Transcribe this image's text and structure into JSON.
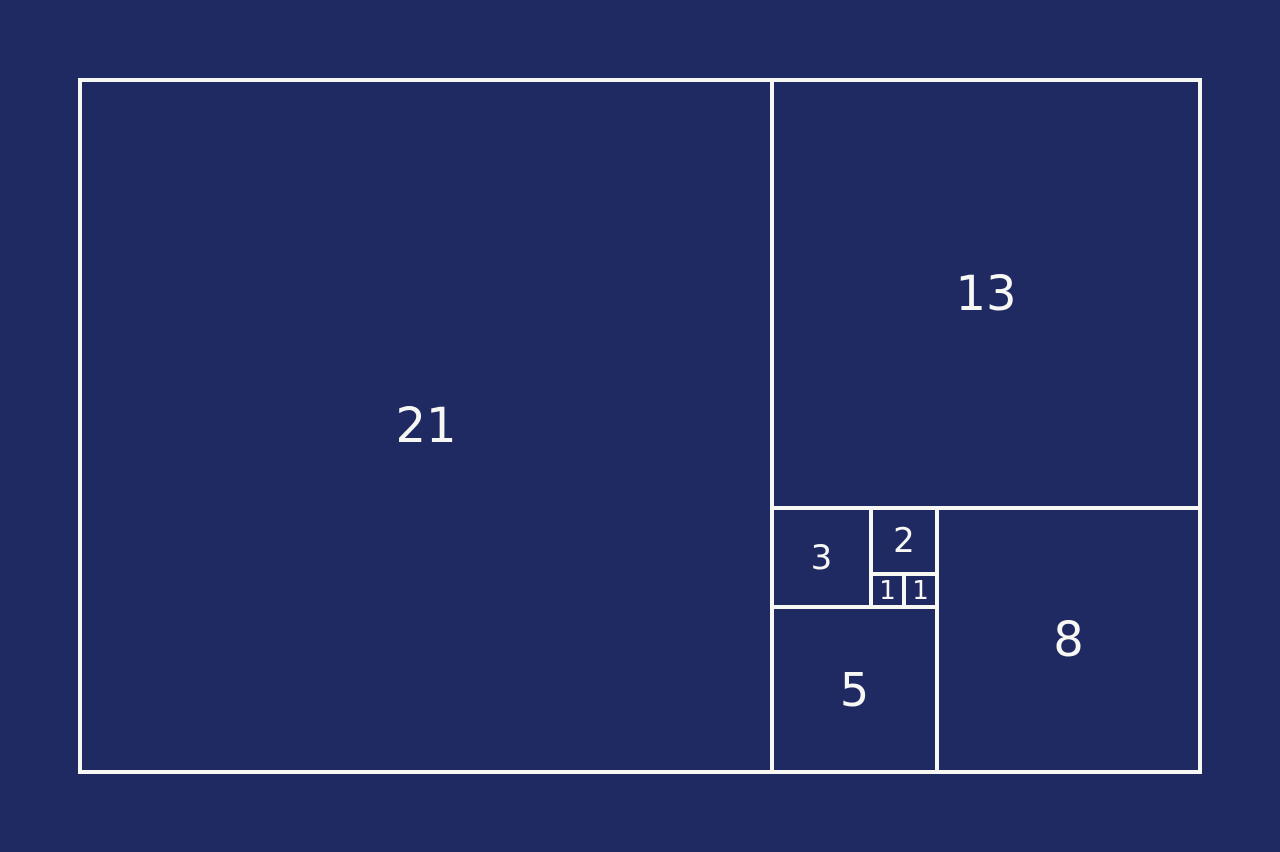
{
  "colors": {
    "background": "#1f2a63",
    "line": "#f7f7f3",
    "text": "#f7f7f3"
  },
  "diagram": {
    "type": "fibonacci-golden-rectangle",
    "units": {
      "width": 34,
      "height": 21
    },
    "origin_px": {
      "x": 80,
      "y": 80
    },
    "unit_px": 32.95,
    "line_px": 4,
    "squares": [
      {
        "label": "21",
        "x": 0,
        "y": 0,
        "size": 21,
        "font_px": 48
      },
      {
        "label": "13",
        "x": 21,
        "y": 0,
        "size": 13,
        "font_px": 48
      },
      {
        "label": "8",
        "x": 26,
        "y": 13,
        "size": 8,
        "font_px": 48
      },
      {
        "label": "5",
        "x": 21,
        "y": 16,
        "size": 5,
        "font_px": 46
      },
      {
        "label": "3",
        "x": 21,
        "y": 13,
        "size": 3,
        "font_px": 34
      },
      {
        "label": "2",
        "x": 24,
        "y": 13,
        "size": 2,
        "font_px": 34
      },
      {
        "label": "1",
        "x": 24,
        "y": 15,
        "size": 1,
        "font_px": 26
      },
      {
        "label": "1",
        "x": 25,
        "y": 15,
        "size": 1,
        "font_px": 26
      }
    ]
  }
}
